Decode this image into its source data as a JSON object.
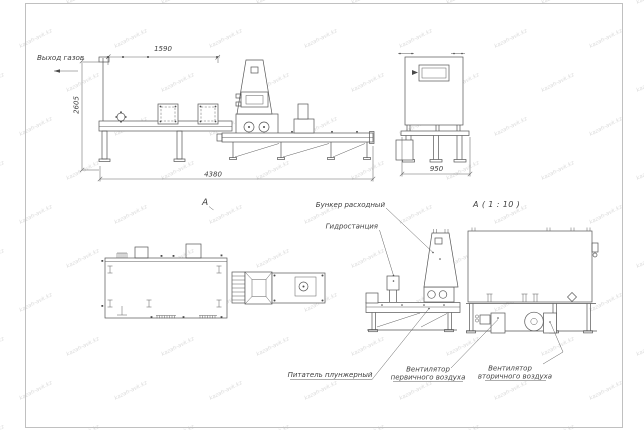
{
  "sheet": {
    "background": "#ffffff",
    "line_color": "#555555",
    "dim_color": "#666666",
    "frame_color": "#c0c0c0",
    "text_color": "#3e3e3e"
  },
  "watermark": {
    "text": "kazah-avk.kz",
    "color": "#dbdbdb",
    "font_size": 5.5,
    "angle": -27,
    "rows": 11,
    "cols": 8,
    "dx": 95,
    "dy": 44
  },
  "views": {
    "side": {
      "gas_outlet_label": "Выход газов",
      "dim_top": "1590",
      "dim_left": "2605",
      "dim_bottom": "4380"
    },
    "front": {
      "dim_bottom": "950"
    },
    "section_arrow_label": "A",
    "detail": {
      "title": "A ( 1 : 10 )"
    }
  },
  "callouts": {
    "bunker": "Бункер расходный",
    "hydro": "Гидростанция",
    "feeder": "Питатель плунжерный",
    "fan_primary": {
      "l1": "Вентилятор",
      "l2": "первичного воздуха"
    },
    "fan_secondary": {
      "l1": "Вентилятор",
      "l2": "вторичного воздуха"
    }
  }
}
